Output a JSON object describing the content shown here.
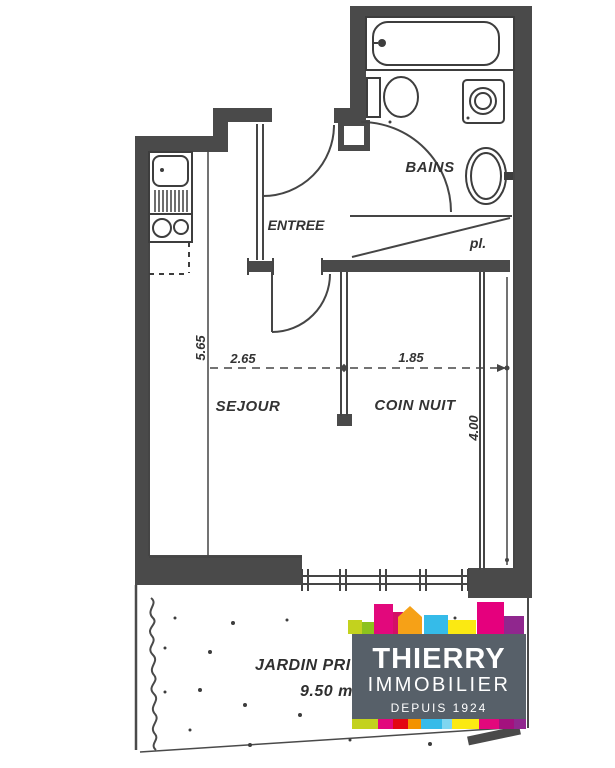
{
  "plan": {
    "ink_color": "#454545",
    "wall_color": "#4a4a4a",
    "rooms": {
      "bains": "BAINS",
      "entree": "ENTREE",
      "placard": "pl.",
      "sejour": "SEJOUR",
      "coin_nuit": "COIN NUIT",
      "jardin_label": "JARDIN PRIVA",
      "jardin_area": "9.50 m"
    },
    "dimensions": {
      "left_height": "5.65",
      "sejour_width": "2.65",
      "coin_nuit_width": "1.85",
      "coin_nuit_height": "4.00"
    }
  },
  "logo": {
    "title": "THIERRY",
    "subtitle": "IMMOBILIER",
    "tagline": "DEPUIS 1924",
    "panel_color": "#576069",
    "text_color": "#ffffff",
    "skyline_colors": {
      "lime": "#c3d21e",
      "green": "#8cc21c",
      "magenta": "#e2087c",
      "house_wall": "#d30f66",
      "house_roof": "#f6a117",
      "cyan": "#35bbe9",
      "yellow": "#fbe912",
      "magenta2": "#e5007d",
      "purple": "#90278e"
    },
    "strip_colors": [
      "#c3d21e",
      "#e2087c",
      "#e30613",
      "#f39200",
      "#35bbe9",
      "#7fd6f0",
      "#fbe912",
      "#e2087c",
      "#a4117e",
      "#90278e"
    ]
  }
}
